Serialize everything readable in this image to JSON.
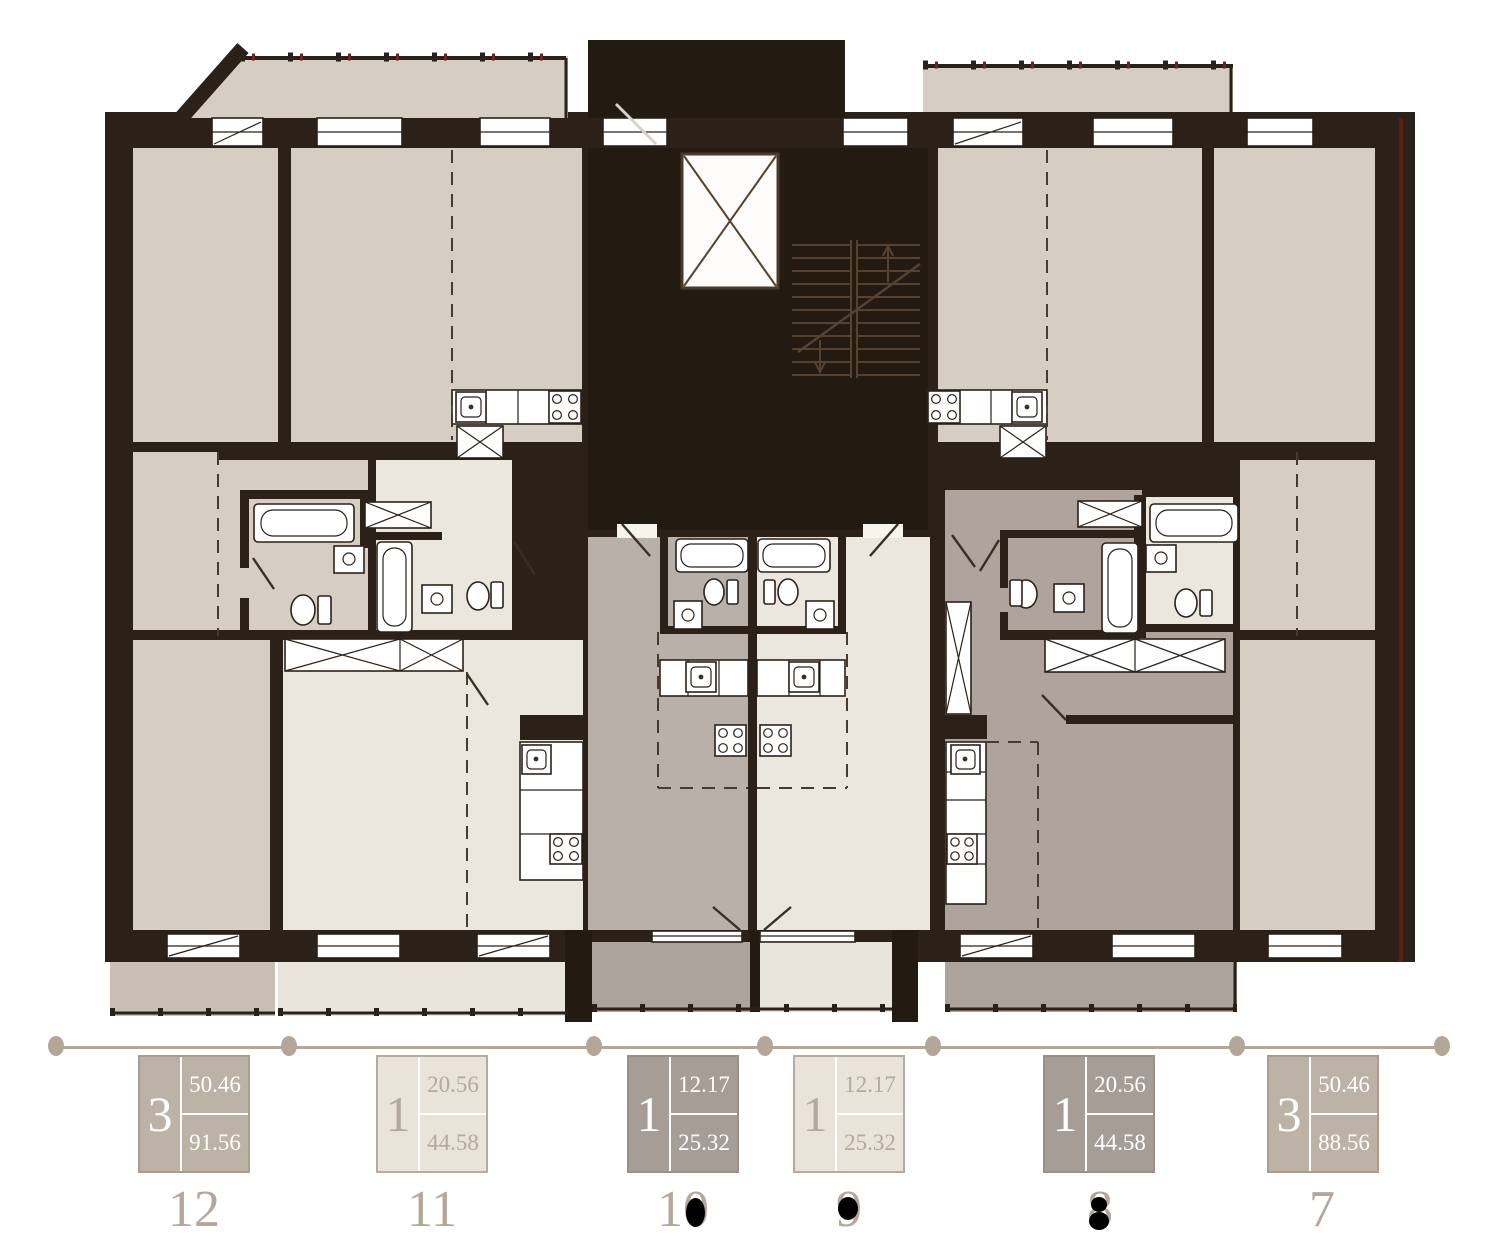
{
  "colors": {
    "wall": "#2b2118",
    "core": "#231a12",
    "room_beige": "#d6cec3",
    "room_cream": "#ebe7de",
    "room_gray_light": "#b9b0a9",
    "room_gray": "#aea49d",
    "balcony_tan": "#c9c0b3",
    "balcony_cream": "#e9e5dc",
    "balcony_gray": "#aca39c",
    "fixture_white": "#ffffff",
    "accent_red": "#5a2014",
    "legend_line": "#b3a797",
    "card_taupe_bg": "#bdb2a6",
    "card_light_bg": "#e9e3da",
    "card_dark_bg": "#a69d96",
    "card_text_light": "#ffffff",
    "card_text_taupe": "#b4a99c",
    "number_color": "#b3a89a"
  },
  "plan": {
    "type": "residential-floor-plan",
    "core_features": [
      "elevator",
      "staircase"
    ],
    "fixtures": [
      "bathtub",
      "toilet",
      "sink",
      "stove",
      "wardrobe"
    ]
  },
  "legend": {
    "apartments": [
      {
        "number": "12",
        "rooms": "3",
        "area_living": "50.46",
        "area_total": "91.56",
        "style": "taupe",
        "counter_filled": false
      },
      {
        "number": "11",
        "rooms": "1",
        "area_living": "20.56",
        "area_total": "44.58",
        "style": "light",
        "counter_filled": false
      },
      {
        "number": "10",
        "rooms": "1",
        "area_living": "12.17",
        "area_total": "25.32",
        "style": "dark",
        "counter_filled": true
      },
      {
        "number": "9",
        "rooms": "1",
        "area_living": "12.17",
        "area_total": "25.32",
        "style": "light",
        "counter_filled": true
      },
      {
        "number": "8",
        "rooms": "1",
        "area_living": "20.56",
        "area_total": "44.58",
        "style": "dark",
        "counter_filled": true
      },
      {
        "number": "7",
        "rooms": "3",
        "area_living": "50.46",
        "area_total": "88.56",
        "style": "taupe",
        "counter_filled": false
      }
    ]
  }
}
